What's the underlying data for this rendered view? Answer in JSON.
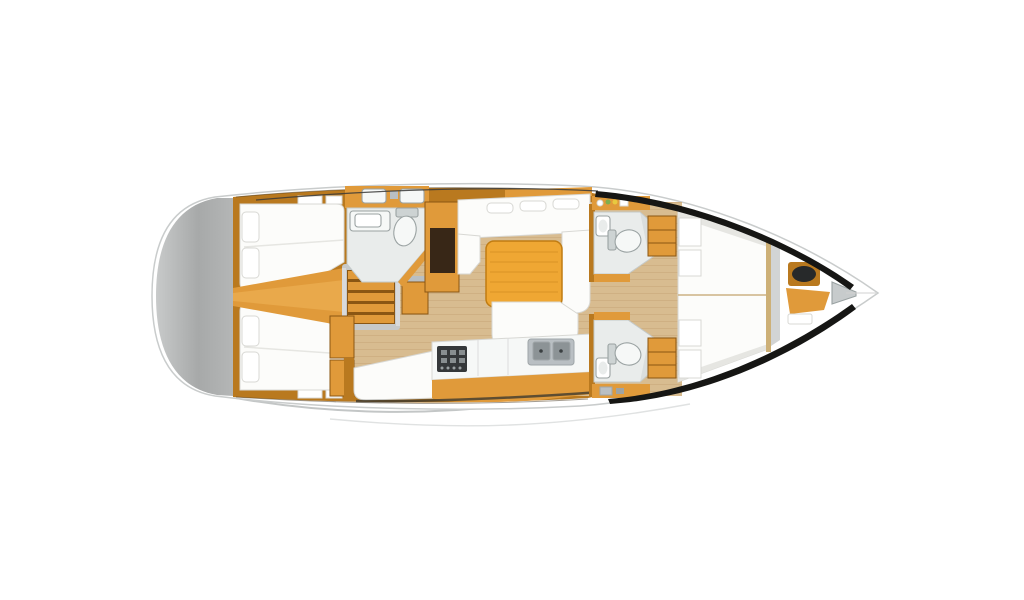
{
  "canvas": {
    "width": 1024,
    "height": 600,
    "background": "#ffffff"
  },
  "diagram": {
    "type": "sailing-yacht-interior-floor-plan",
    "view": "top-down",
    "orientation": "bow-right-stern-left",
    "regions": {
      "swim_platform": "swim platform / transom",
      "aft_cabin_port": "aft double cabin port",
      "aft_cabin_starboard": "aft double cabin starboard",
      "companionway": "companionway steps",
      "aft_head": "aft head with toilet and sink",
      "nav_station": "chart table / locker",
      "saloon": "saloon with U-settee and table",
      "galley": "galley with stove and twin sinks",
      "forward_head_port": "forward head port",
      "forward_head_starboard": "forward head starboard",
      "forward_cabin_port": "forward berth port",
      "forward_cabin_starboard": "forward berth starboard",
      "bow_locker": "bow compartment with hatch"
    }
  },
  "colors": {
    "background": "#ffffff",
    "hull_fill": "#ffffff",
    "hull_stroke": "#c9cccc",
    "hull_shadow": "#c3c6c6",
    "deck_line": "#3a3a38",
    "bulwark": "#161614",
    "transom_light": "#c8caca",
    "transom_mid": "#a7a9a9",
    "wood": "#e09a3a",
    "wood_light": "#f2b85c",
    "wood_dark": "#b9791f",
    "wood_deep": "#8a5613",
    "table_wood": "#efa733",
    "floor": "#d8bc90",
    "floor_line": "#c2a272",
    "mattress": "#fcfcfa",
    "bath_floor": "#e9eceb",
    "bath_wall": "#cdd3d3",
    "fixture": "#f6f8f7",
    "fixture_stroke": "#9aa2a2",
    "dark_panel": "#382717",
    "stove": "#35383a",
    "sink_steel": "#b9bfc3",
    "sink_steel_dark": "#8c9396",
    "shade_gray": "#d2d4d4",
    "cushion_gray": "#c7cbcc",
    "hatch_dark": "#27292a",
    "shelf_green": "#7fae4e",
    "shelf_yellow": "#e8c93f",
    "bulkhead_wood": "#cdb077",
    "rail_gray": "#c7c9c9"
  }
}
